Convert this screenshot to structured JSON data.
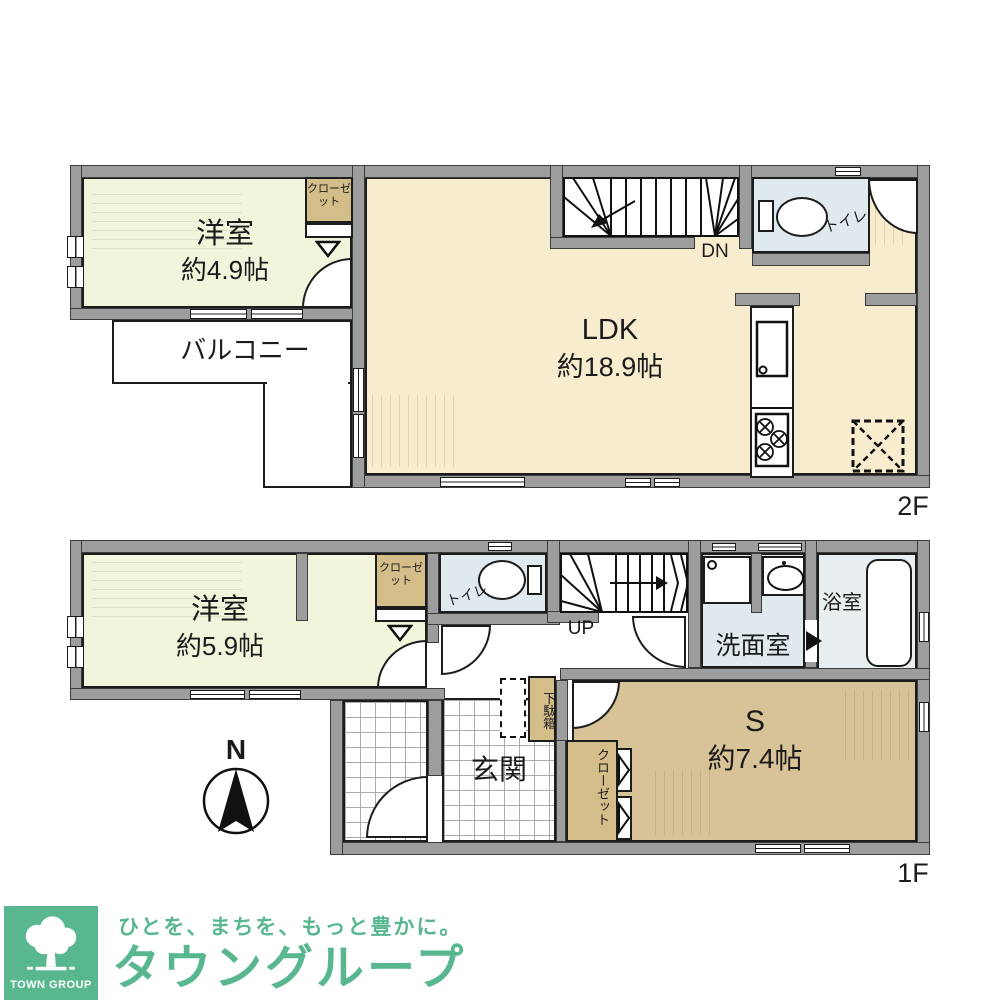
{
  "floor2": {
    "floor_label": "2F",
    "bedroom": {
      "name": "洋室",
      "area": "約4.9帖"
    },
    "closet_label": "クローゼット",
    "balcony_label": "バルコニー",
    "ldk": {
      "name": "LDK",
      "area": "約18.9帖"
    },
    "toilet_label": "トイレ",
    "stairs_label": "DN"
  },
  "floor1": {
    "floor_label": "1F",
    "bedroom": {
      "name": "洋室",
      "area": "約5.9帖"
    },
    "closet_label": "クローゼット",
    "toilet_label": "トイレ",
    "stairs_label": "UP",
    "washroom_label": "洗面室",
    "bathroom_label": "浴室",
    "shoe_cabinet_label": "下駄箱",
    "entrance_label": "玄関",
    "service_room": {
      "name": "S",
      "area": "約7.4帖"
    },
    "service_closet_label": "クローゼット"
  },
  "compass": {
    "north_label": "N"
  },
  "branding": {
    "logo_caption": "TOWN GROUP",
    "tagline": "ひとを、まちを、もっと豊かに。",
    "company_name": "タウングループ",
    "brand_color": "#58b78f"
  },
  "palette": {
    "wall_gray": "#9d9d9d",
    "ldk_floor": "#f8ecce",
    "bedroom_floor": "#f2f4dc",
    "closet_floor": "#d3be8a",
    "service_floor": "#d7c397",
    "wet_area_floor": "#e0eaee"
  }
}
